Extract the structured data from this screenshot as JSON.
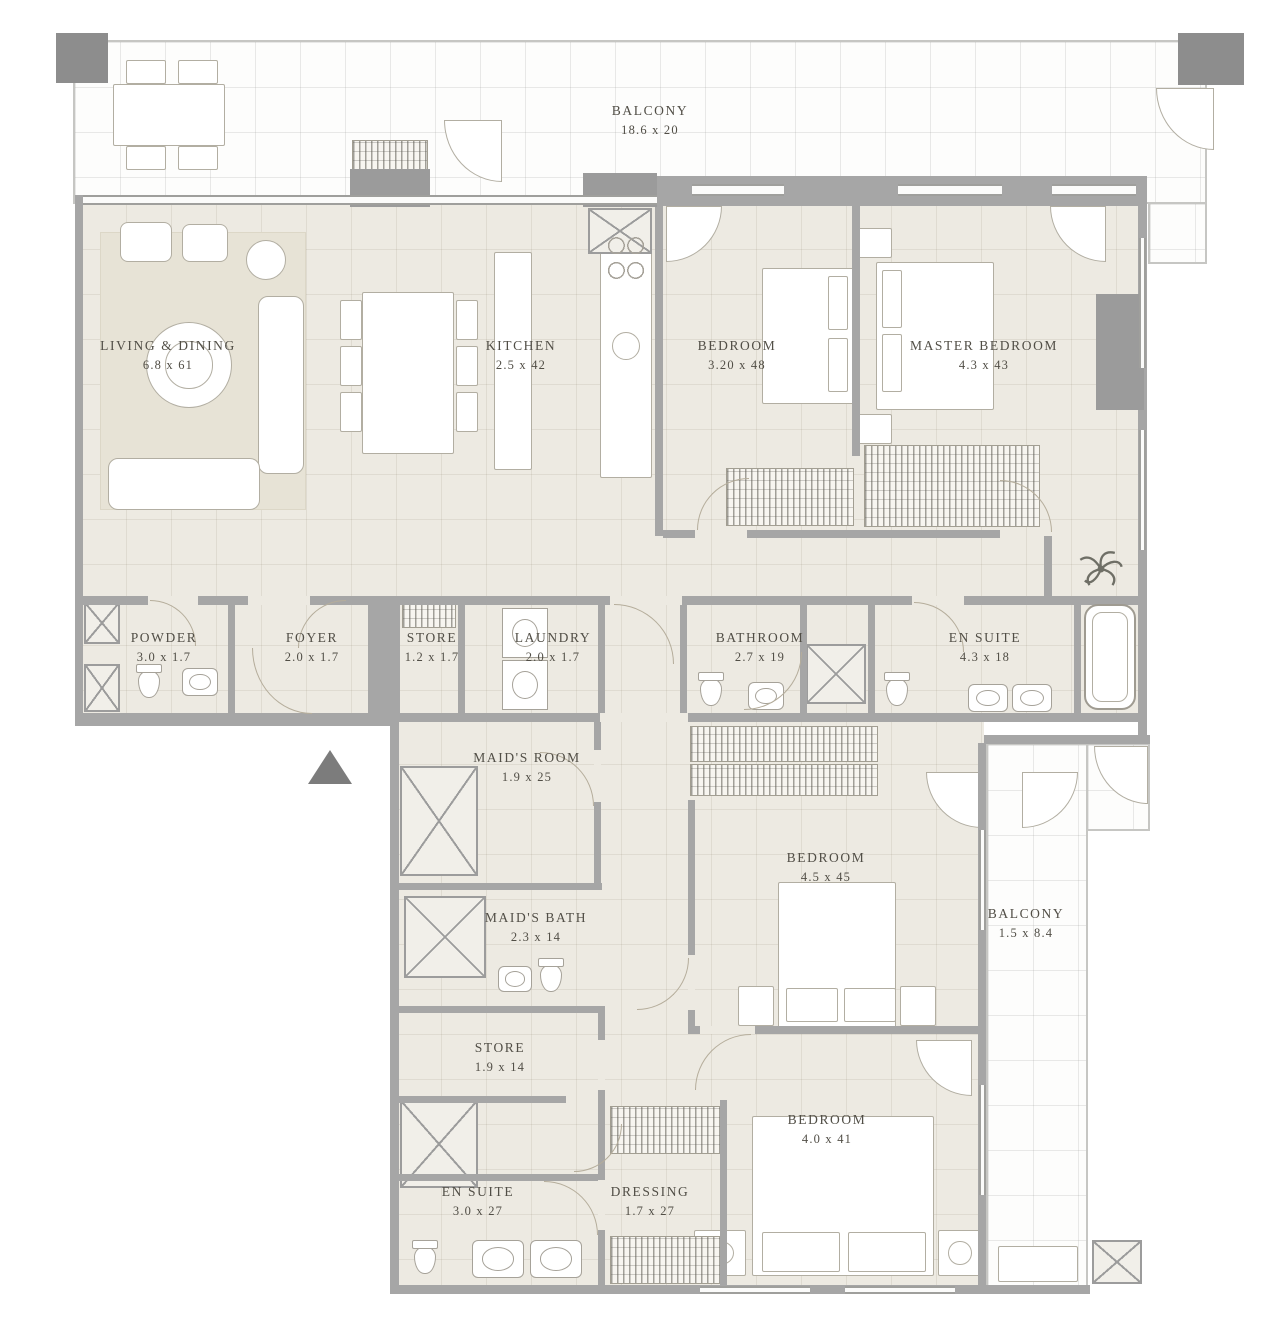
{
  "plan": {
    "rooms": [
      {
        "id": "balcony-top",
        "label": "BALCONY",
        "dims": "18.6 x 20"
      },
      {
        "id": "living-dining",
        "label": "LIVING & DINING",
        "dims": "6.8 x 61"
      },
      {
        "id": "kitchen",
        "label": "KITCHEN",
        "dims": "2.5 x 42"
      },
      {
        "id": "bedroom-1",
        "label": "BEDROOM",
        "dims": "3.20 x 48"
      },
      {
        "id": "master-bedroom",
        "label": "MASTER BEDROOM",
        "dims": "4.3 x 43"
      },
      {
        "id": "powder",
        "label": "POWDER",
        "dims": "3.0 x 1.7"
      },
      {
        "id": "foyer",
        "label": "FOYER",
        "dims": "2.0 x 1.7"
      },
      {
        "id": "store-1",
        "label": "STORE",
        "dims": "1.2 x 1.7"
      },
      {
        "id": "laundry",
        "label": "LAUNDRY",
        "dims": "2.0 x 1.7"
      },
      {
        "id": "bathroom",
        "label": "BATHROOM",
        "dims": "2.7 x 19"
      },
      {
        "id": "en-suite-1",
        "label": "EN SUITE",
        "dims": "4.3 x 18"
      },
      {
        "id": "maids-room",
        "label": "MAID'S ROOM",
        "dims": "1.9 x 25"
      },
      {
        "id": "maids-bath",
        "label": "MAID'S BATH",
        "dims": "2.3 x 14"
      },
      {
        "id": "bedroom-2",
        "label": "BEDROOM",
        "dims": "4.5 x 45"
      },
      {
        "id": "balcony-side",
        "label": "BALCONY",
        "dims": "1.5 x 8.4"
      },
      {
        "id": "store-2",
        "label": "STORE",
        "dims": "1.9 x 14"
      },
      {
        "id": "bedroom-3",
        "label": "BEDROOM",
        "dims": "4.0 x 41"
      },
      {
        "id": "en-suite-2",
        "label": "EN SUITE",
        "dims": "3.0 x 27"
      },
      {
        "id": "dressing",
        "label": "DRESSING",
        "dims": "1.7 x 27"
      }
    ],
    "icons": {
      "entrance": "entrance-triangle-icon",
      "palm": "palm-tree-icon"
    },
    "colors": {
      "wall": "#a6a6a6",
      "wall_dark": "#8d8d8d",
      "floor": "#edeae2",
      "balcony_floor": "#fdfdfc",
      "label_text": "#514e46",
      "furniture_outline": "#b2aea2"
    }
  }
}
